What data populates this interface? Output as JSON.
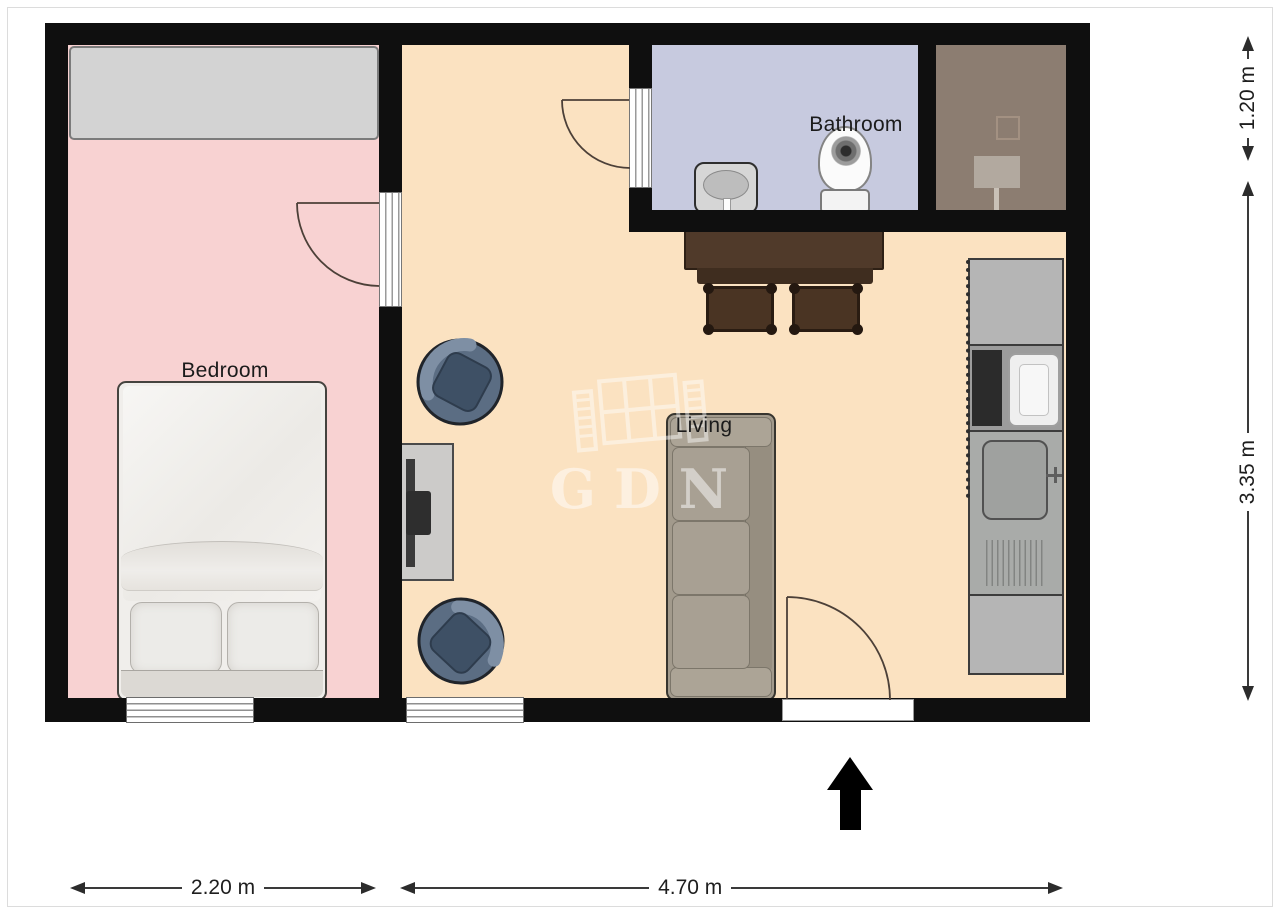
{
  "page": {
    "type": "apartment-floor-plan"
  },
  "rooms": {
    "bedroom": {
      "label": "Bedroom"
    },
    "bathroom": {
      "label": "Bathroom"
    },
    "living": {
      "label": "Living"
    }
  },
  "dimensions": {
    "bedroom_width": "2.20 m",
    "living_width": "4.70 m",
    "bathroom_depth": "1.20 m",
    "living_depth": "3.35 m"
  },
  "watermark": {
    "text": "GDN"
  },
  "icons": {
    "north_arrow": "solid black arrow pointing up",
    "door_swing": "quarter-circle arc",
    "window": "white strip with parallel lines in wall"
  },
  "colors": {
    "wall": "#0f0f0f",
    "bedroom_floor": "#f8d2d2",
    "living_floor": "#fbe2c1",
    "bathroom_floor": "#c7cadf",
    "utility_floor": "#8c7d71",
    "closet": "#d3d3d3",
    "bed": "#f0eeeb",
    "sofa": "#a29a8c",
    "armchair": "#5b6d83",
    "armchair_cushion": "#3e5065",
    "table": "#503a2a",
    "stool": "#4a3423",
    "counter": "#b5b5b5",
    "dimension_text": "#1e1e1e",
    "label_text": "#1b1b1b",
    "watermark_color": "#ffffff"
  }
}
